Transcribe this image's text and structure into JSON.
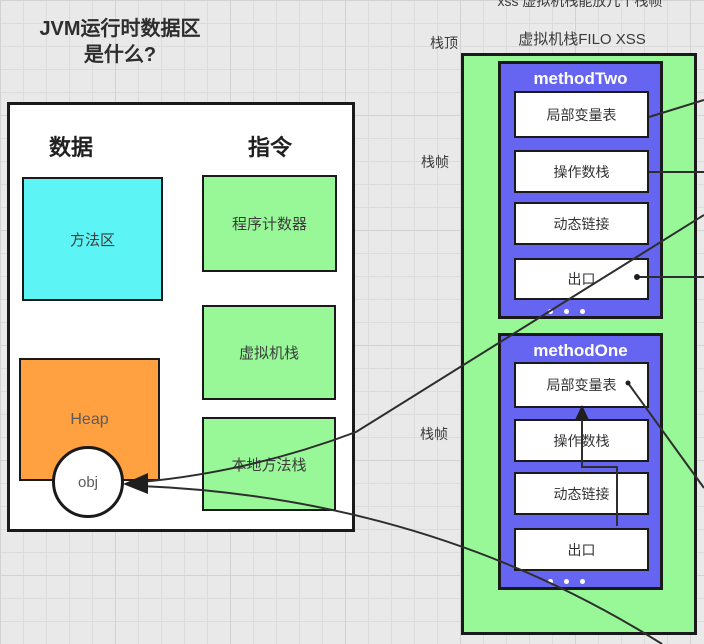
{
  "page": {
    "title_line1": "JVM运行时数据区",
    "title_line2": "是什么?",
    "top_note": "xss 虚拟机栈能放几个栈帧",
    "stack_caption": "虚拟机栈FILO XSS"
  },
  "labels": {
    "stack_top": "栈顶",
    "stack_frame_upper": "栈帧",
    "stack_frame_lower": "栈帧"
  },
  "memory_box": {
    "data_header": "数据",
    "instruction_header": "指令",
    "method_area": "方法区",
    "program_counter": "程序计数器",
    "vm_stack": "虚拟机栈",
    "native_method_stack": "本地方法栈",
    "heap": "Heap",
    "obj": "obj"
  },
  "frames": [
    {
      "title": "methodTwo",
      "slots": [
        "局部变量表",
        "操作数栈",
        "动态链接",
        "出口"
      ]
    },
    {
      "title": "methodOne",
      "slots": [
        "局部变量表",
        "操作数栈",
        "动态链接",
        "出口"
      ]
    }
  ],
  "colors": {
    "canvas_bg": "#e9e9e9",
    "method_area_cyan": "#5cf4f4",
    "green": "#98f898",
    "frame_purple": "#6565f1",
    "heap_orange": "#ffa041",
    "shape_border": "#1a1a1a",
    "connector": "#2e2e2e"
  }
}
